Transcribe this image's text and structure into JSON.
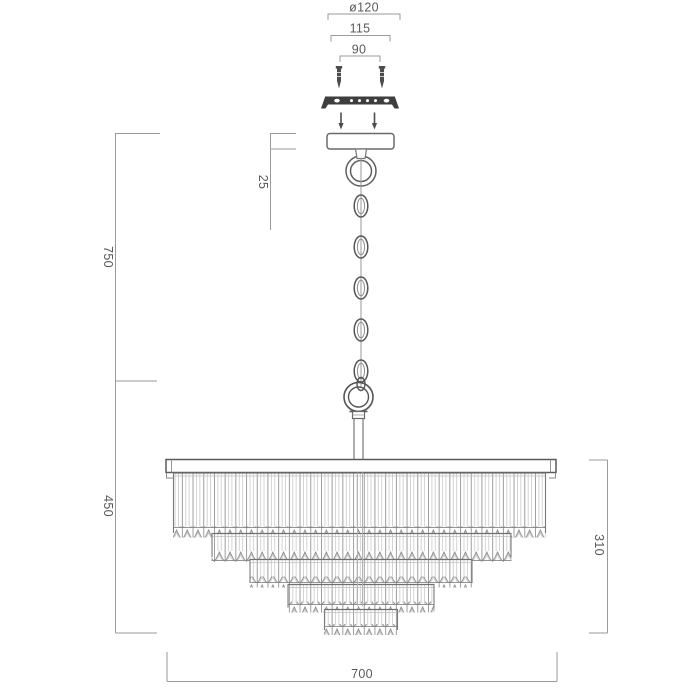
{
  "colors": {
    "background": "#ffffff",
    "outline": "#4d4d4d",
    "dim_line": "#9a9a9a",
    "label_text": "#5a5a5a"
  },
  "dims": {
    "mount_diameter": "ø120",
    "mount_width": "115",
    "screw_spacing": "90",
    "canopy_height": "25",
    "upper_drop": "750",
    "lower_drop": "450",
    "shade_height": "310",
    "shade_diameter": "700"
  }
}
